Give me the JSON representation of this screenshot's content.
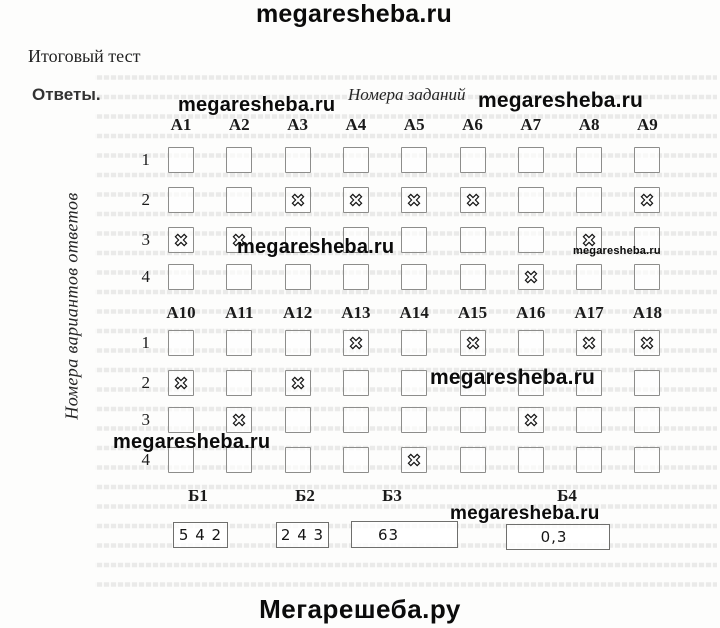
{
  "labels": {
    "title": "Итоговый тест",
    "answers": "Ответы.",
    "columns_axis": "Номера заданий",
    "rows_axis": "Номера вариантов ответов"
  },
  "watermarks": {
    "top": "megaresheba.ru",
    "header_left": "megaresheba.ru",
    "header_right": "megaresheba.ru",
    "grid1_mid": "megaresheba.ru",
    "grid1_small": "megaresheba.ru",
    "grid2_mid": "megaresheba.ru",
    "grid2_left": "megaresheba.ru",
    "part_b": "megaresheba.ru",
    "footer": "Мегарешеба.ру"
  },
  "grid1": {
    "columns": [
      "А1",
      "А2",
      "А3",
      "А4",
      "А5",
      "А6",
      "А7",
      "А8",
      "А9"
    ],
    "row_options": [
      "1",
      "2",
      "3",
      "4"
    ],
    "answers": {
      "А1": "3",
      "А2": "3",
      "А3": "2",
      "А4": "2",
      "А5": "2",
      "А6": "2",
      "А7": "4",
      "А8": "3",
      "А9": "2"
    }
  },
  "grid2": {
    "columns": [
      "А10",
      "А11",
      "А12",
      "А13",
      "А14",
      "А15",
      "А16",
      "А17",
      "А18"
    ],
    "row_options": [
      "1",
      "2",
      "3",
      "4"
    ],
    "answers": {
      "А10": "2",
      "А11": "3",
      "А12": "2",
      "А13": "1",
      "А14": "4",
      "А15": "1",
      "А16": "3",
      "А17": "1",
      "А18": "1"
    }
  },
  "part_b": [
    {
      "label": "Б1",
      "value": "5 4 2"
    },
    {
      "label": "Б2",
      "value": "2 4 3"
    },
    {
      "label": "Б3",
      "value": "63"
    },
    {
      "label": "Б4",
      "value": "0,3"
    }
  ]
}
